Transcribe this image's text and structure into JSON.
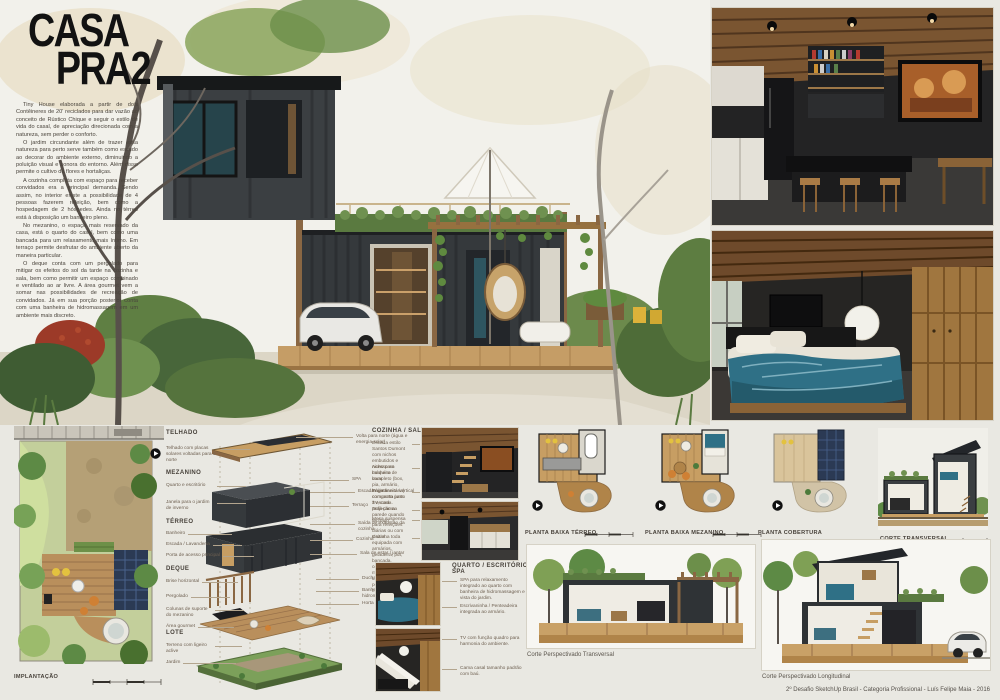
{
  "title": {
    "line1": "CASA",
    "line2": "PRA2"
  },
  "intro": [
    "Tiny House elaborada a partir de dois Contêineres de 20' reciclados para dar vazão ao conceito de Rústico Chique e seguir o estilo de vida do casal, de apreciação direcionada com a natureza, sem perder o conforto.",
    "O jardim circundante além de trazer essa natureza para perto serve também como escudo ao decorar do ambiente externo, diminuindo a poluição visual e sonora do entorno. Além disso permite o cultivo de flores e hortaliças.",
    "A cozinha completa com espaço para receber convidados era a principal demanda. Sendo assim, no interior existe a possibilidade de 4 pessoas fazerem refeição, bem como a hospedagem de 2 hóspedes. Ainda no térreo está à disposição um banheiro pleno.",
    "No mezanino, o espaço mais reservado da casa, está o quarto do casal, bem como uma bancada para um relaxamento mais íntimo. Em terraço permite desfrutar do ambiente aberto da maneira particular.",
    "O deque conta com um pergolado para mitigar os efeitos do sol da tarde na cozinha e sala, bem como permitir um espaço combinado e ventilado ao ar livre. A área gourmet vem a somar nas possibilidades de recreação de convidados. Já em sua porção posterior conta com uma banheira de hidromassagem em um ambiente mais discreto."
  ],
  "implantacao": {
    "label": "IMPLANTAÇÃO"
  },
  "exploded": {
    "telhado": {
      "heading": "TELHADO",
      "left": [
        "Telhado com placas solares voltadas para o norte"
      ],
      "right": [
        "Volta para norte (água e energia solar)"
      ]
    },
    "mezanino": {
      "heading": "MEZANINO",
      "left": [
        "Quarto e escritório",
        "Janela para o jardim de inverno"
      ],
      "right": [
        "SPA",
        "Escada / jardineira vertical",
        "Terraço"
      ]
    },
    "terreo": {
      "heading": "TÉRREO",
      "left": [
        "Banheiro",
        "Escada / Lavanderia",
        "Porta de acesso principal"
      ],
      "right": [
        "Saída de exaustão da cozinha",
        "Cozinha",
        "Sala de estar / jantar"
      ]
    },
    "deque": {
      "heading": "DEQUE",
      "left": [
        "Brise horizontal",
        "Pergolado",
        "Colunas de suporte do mezanino",
        "Área gourmet"
      ],
      "right": [
        "Ducha",
        "Banheira de hidromassagem",
        "Horta"
      ]
    },
    "lote": {
      "heading": "LOTE",
      "left": [
        "Terreno com ligeiro aclive",
        "Jardim"
      ]
    }
  },
  "cozinha": {
    "heading": "COZINHA / SALA",
    "notes": [
      "Escada estilo Santos Dumont com nichos embutidos e nicho para máquina de lavar.",
      "Acesso ao banheiro completo (box, pia, armário, louça sanitária) com porta junto à escada.",
      "Projetor compacto para TV, com projeção na parede quando fechado.",
      "Sofá cama.",
      "Mesa suspensa para refeições diárias ou com visitas.",
      "Cozinha toda equipada com armários, geladeira, pia, bancada, cooktop, forno, micro-ondas, lava-louças e pequena adega francesa."
    ]
  },
  "quarto": {
    "heading": "QUARTO / ESCRITÓRIO / SPA",
    "notes": [
      "SPA para relaxamento integrado ao quarto com banheira de hidromassagem e vista do jardim.",
      "Escrivaninha / Penteadeira integrada ao armário.",
      "TV com função quadro para harmonia do ambiente.",
      "Cama casal tamanho padrão com baú."
    ]
  },
  "plans": {
    "terreo": "PLANTA BAIXA TÉRREO",
    "mezanino": "PLANTA BAIXA MEZANINO",
    "cobertura": "PLANTA COBERTURA",
    "corte": "CORTE TRANSVERSAL"
  },
  "sections": {
    "transversal": "Corte Perspectivado Transversal",
    "longitudinal": "Corte Perspectivado Longitudinal"
  },
  "footer": {
    "credit": "2º Desafio SketchUp Brasil - Categoria Profissional - Luís Felipe Maia - 2016"
  },
  "colors": {
    "board_bg": "#e9e8e2",
    "render_sky": "#f2f1eb",
    "container_dark": "#35393c",
    "wood": "#c79e63",
    "deck_wood": "#b98f5c",
    "green": "#5f7f43",
    "green_roof": "#5a7a40",
    "solar_panel": "#2b3a54",
    "teal_bed": "#2f7086",
    "tv_warm": "#a85f2a",
    "label_line": "#b3a58e"
  }
}
